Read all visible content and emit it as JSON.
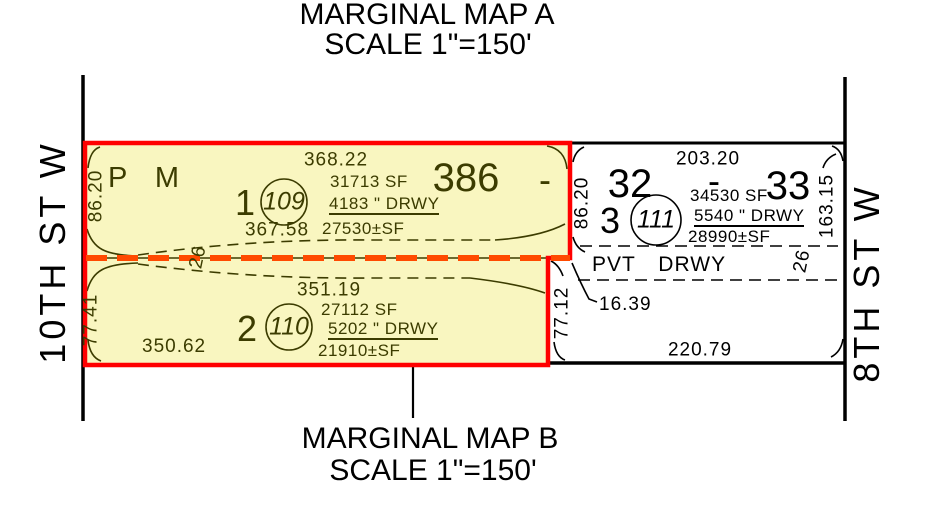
{
  "map_a": {
    "title": "MARGINAL MAP A",
    "scale": "SCALE 1\"=150'"
  },
  "map_b": {
    "title": "MARGINAL MAP B",
    "scale": "SCALE 1\"=150'"
  },
  "streets": {
    "west": "10TH ST W",
    "east": "8TH ST W"
  },
  "highlight": {
    "map_label": "P M",
    "book_number": "386",
    "dash": "-",
    "parcel_1": {
      "lot": "1",
      "parcel_circle": "109",
      "north_dim": "368.22",
      "gross_sf": "31713 SF",
      "drwy_sf": "4183 \" DRWY",
      "net_sf": "27530±SF",
      "south_dim": "367.58",
      "west_dim": "86.20"
    },
    "parcel_2": {
      "lot": "2",
      "parcel_circle": "110",
      "north_dim": "351.19",
      "gross_sf": "27112 SF",
      "drwy_sf": "5202 \" DRWY",
      "net_sf": "21910±SF",
      "south_dim": "350.62",
      "west_dim": "77.41"
    }
  },
  "east_block": {
    "lot_left": "32",
    "lot_right": "33",
    "lots_dash": "-",
    "north_dim": "203.20",
    "parcel_3": {
      "lot": "3",
      "parcel_circle": "111",
      "gross_sf": "34530 SF",
      "drwy_sf": "5540 \" DRWY",
      "net_sf": "28990±SF"
    },
    "west_dim": "86.20",
    "east_dim": "163.15",
    "offset_dim": "16.39",
    "south_west_dim": "77.12",
    "south_dim": "220.79"
  },
  "pvt_drwy": {
    "label": "PVT DRWY",
    "width_west": "26",
    "width_east": "26"
  },
  "colors": {
    "highlight_fill": "#f9f6c0",
    "highlight_border": "#ff0000",
    "centerline_orange": "#ff4a00",
    "ink_olive": "#3c3c00",
    "ink_black": "#000000"
  }
}
